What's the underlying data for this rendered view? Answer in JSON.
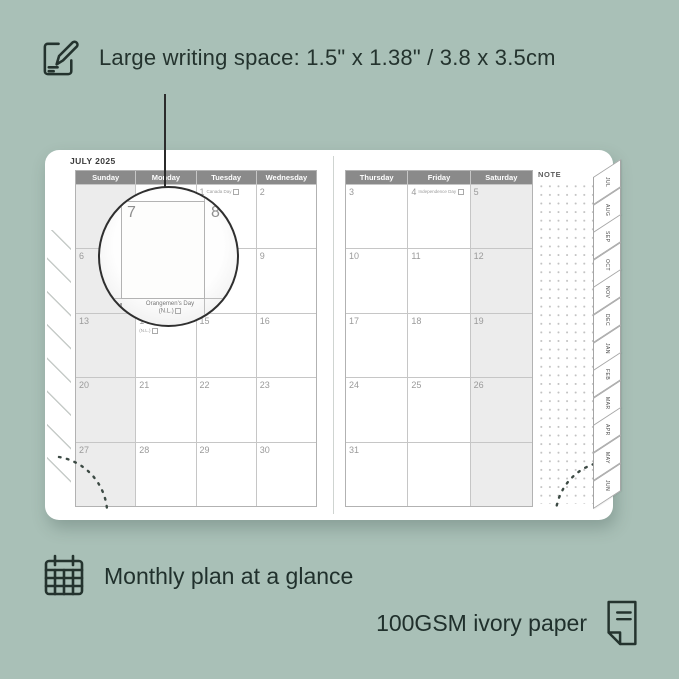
{
  "colors": {
    "background": "#a9c0b7",
    "ink": "#24332e",
    "header_bar": "#8a8a8a",
    "weekend_fill": "#ececec",
    "grid_line": "#c6c6c6",
    "date_text": "#9a9a9a",
    "page": "#ffffff"
  },
  "top_annotation": {
    "icon": "pencil-note-icon",
    "text": "Large writing space: 1.5\" x 1.38\" / 3.8 x 3.5cm"
  },
  "planner": {
    "month_title": "JULY 2025",
    "note_label": "NOTE",
    "left_page": {
      "day_headers": [
        "Sunday",
        "Monday",
        "Tuesday",
        "Wednesday"
      ],
      "weekend_columns": [
        0
      ],
      "weeks": [
        [
          {},
          {},
          {
            "day": "1",
            "holiday": "Canada Day"
          },
          {
            "day": "2"
          }
        ],
        [
          {
            "day": "6"
          },
          {
            "day": "7"
          },
          {
            "day": "8"
          },
          {
            "day": "9"
          }
        ],
        [
          {
            "day": "13"
          },
          {
            "day": "14",
            "holiday": "Orangemen's Day (N.L.)"
          },
          {
            "day": "15"
          },
          {
            "day": "16"
          }
        ],
        [
          {
            "day": "20"
          },
          {
            "day": "21"
          },
          {
            "day": "22"
          },
          {
            "day": "23"
          }
        ],
        [
          {
            "day": "27"
          },
          {
            "day": "28"
          },
          {
            "day": "29"
          },
          {
            "day": "30"
          }
        ]
      ]
    },
    "right_page": {
      "day_headers": [
        "Thursday",
        "Friday",
        "Saturday"
      ],
      "weekend_columns": [
        2
      ],
      "weeks": [
        [
          {
            "day": "3"
          },
          {
            "day": "4",
            "holiday": "Independence Day"
          },
          {
            "day": "5"
          }
        ],
        [
          {
            "day": "10"
          },
          {
            "day": "11"
          },
          {
            "day": "12"
          }
        ],
        [
          {
            "day": "17"
          },
          {
            "day": "18"
          },
          {
            "day": "19"
          }
        ],
        [
          {
            "day": "24"
          },
          {
            "day": "25"
          },
          {
            "day": "26"
          }
        ],
        [
          {
            "day": "31"
          },
          {},
          {}
        ]
      ]
    },
    "tabs": [
      "JUL",
      "AUG",
      "SEP",
      "OCT",
      "NOV",
      "DEC",
      "JAN",
      "FEB",
      "MAR",
      "APR",
      "MAY",
      "JUN"
    ],
    "magnifier": {
      "large_day": "7",
      "adjacent_day": "8",
      "footer_day": "14",
      "footer_holiday": "Orangemen's Day",
      "footer_region": "(N.L.)"
    }
  },
  "bottom_annotations": {
    "monthly": "Monthly plan at a glance",
    "paper": "100GSM ivory paper"
  }
}
